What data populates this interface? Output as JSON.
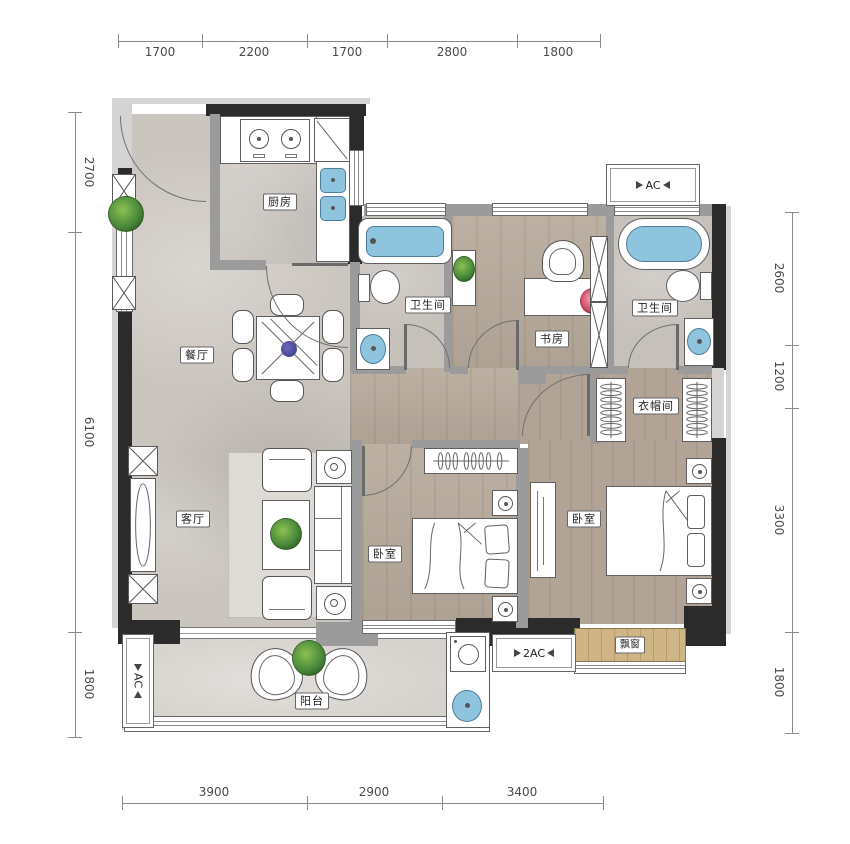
{
  "plan": {
    "dimensions": {
      "top": [
        "1700",
        "2200",
        "1700",
        "2800",
        "1800"
      ],
      "bottom": [
        "3900",
        "2900",
        "3400"
      ],
      "left": [
        "2700",
        "6100",
        "1800"
      ],
      "right": [
        "2600",
        "1200",
        "3300",
        "1800"
      ]
    },
    "rooms": {
      "kitchen": "厨房",
      "dining": "餐厅",
      "living": "客厅",
      "bathroom_1": "卫生间",
      "study": "书房",
      "bathroom_2": "卫生间",
      "cloakroom": "衣帽间",
      "bedroom_1": "卧室",
      "bedroom_2": "卧室",
      "balcony": "阳台",
      "bay_window": "飘窗"
    },
    "equipment": {
      "ac_top": "AC",
      "ac_balcony": "AC",
      "ac_double": "2AC"
    },
    "colors": {
      "wall": "#2b2b2b",
      "partition": "#9b9b9b",
      "water": "#8fc4de",
      "plant": "#4c8a3c",
      "marble_floor": "#cbc5bf",
      "wood_floor": "#b6a99b"
    }
  }
}
